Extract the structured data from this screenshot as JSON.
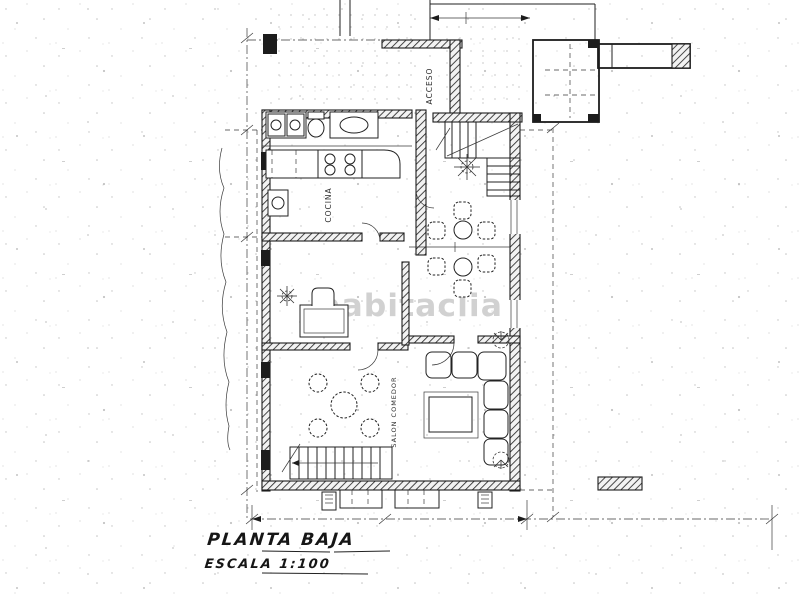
{
  "watermark": {
    "text": "habitaclia",
    "color": "#c6c6c6"
  },
  "title_block": {
    "title": "PLANTA BAJA",
    "scale": "ESCALA 1:100"
  },
  "room_labels": {
    "entrance": "ACCESO",
    "kitchen": "COCINA",
    "living_dining": "SALON COMEDOR"
  },
  "colors": {
    "ink": "#1f1f1f",
    "paper": "#ffffff",
    "watermark_gray": "#c6c6c6"
  }
}
